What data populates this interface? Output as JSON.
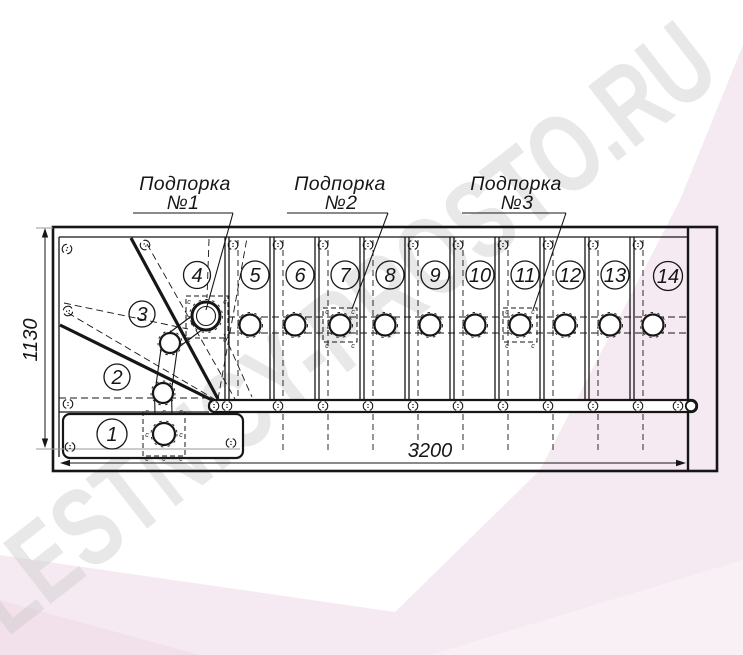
{
  "watermark": {
    "text": "LESTNICY-PROSTO.RU"
  },
  "supports": [
    {
      "line1": "Подпорка",
      "line2": "№1"
    },
    {
      "line1": "Подпорка",
      "line2": "№2"
    },
    {
      "line1": "Подпорка",
      "line2": "№3"
    }
  ],
  "dimensions": {
    "width_mm": "3200",
    "height_mm": "1130"
  },
  "steps": [
    "1",
    "2",
    "3",
    "4",
    "5",
    "6",
    "7",
    "8",
    "9",
    "10",
    "11",
    "12",
    "13",
    "14"
  ],
  "fastener_mark": "c",
  "colors": {
    "background_pink": "#f6eaf2",
    "background_pink_light": "#f9f0f5",
    "background_pink_deep": "#f2e1eb",
    "watermark_gray": "#c9c9c9",
    "line_black": "#161616"
  }
}
